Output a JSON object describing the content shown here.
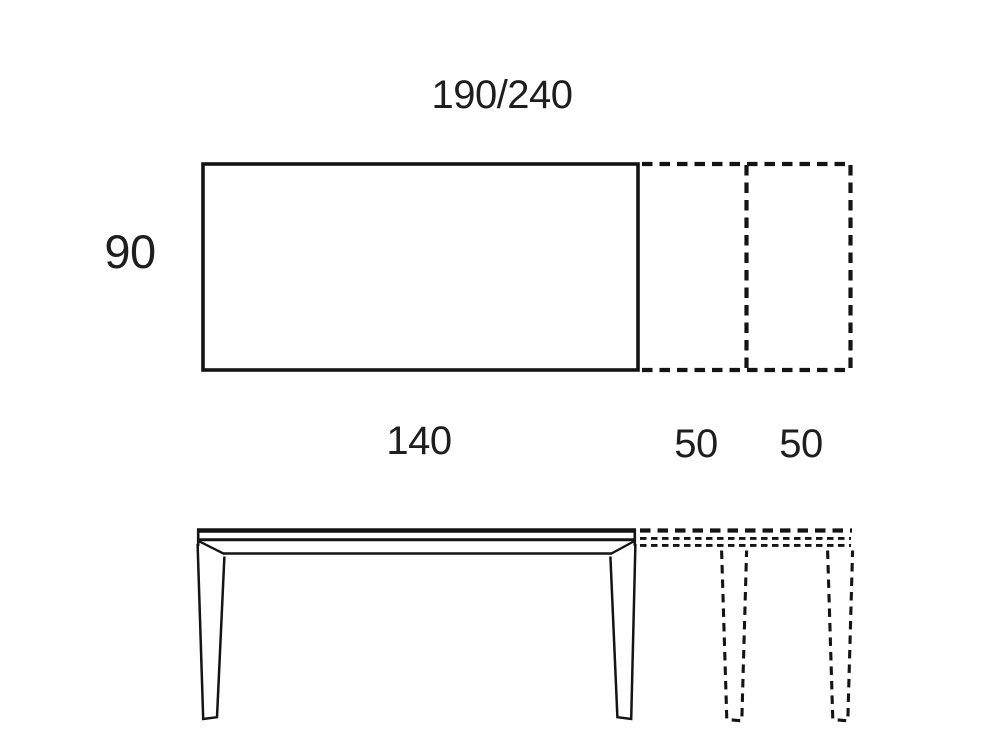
{
  "colors": {
    "background": "#ffffff",
    "line": "#141414",
    "text": "#1e1e1e"
  },
  "plan_view": {
    "width_label": "190/240",
    "depth_label": "90"
  },
  "elevation_view": {
    "closed_length_label": "140",
    "extension_labels": [
      "50",
      "50"
    ]
  }
}
